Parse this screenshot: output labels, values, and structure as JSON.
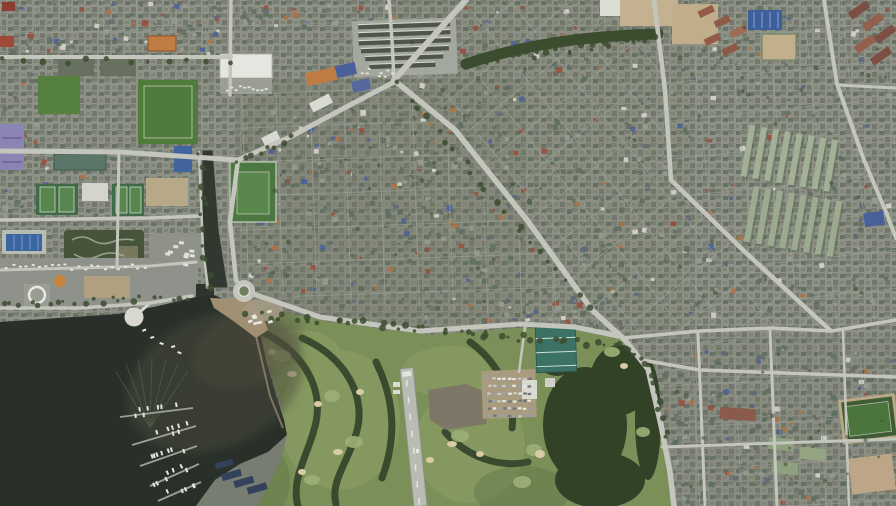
{
  "scene": {
    "type": "satellite-aerial-photograph",
    "description": "Daytime satellite view of a dense coastal city: dark harbor lake with marina piers and moored boats (lower left), a traffic roundabout at the lake head, a canal, sports-and-leisure grounds (upper left), rows of market sheds and a large road junction (top center), tightly packed low-rise housing grids, apartment-row complexes (right), and a large golf course with a small airstrip and parking lot (bottom center)",
    "features": [
      {
        "name": "harbor-lake",
        "label": "dark harbor lake"
      },
      {
        "name": "sediment-plume",
        "label": "brown shallow-water plume"
      },
      {
        "name": "marina-piers",
        "label": "piers with moored boats"
      },
      {
        "name": "wake-streaks",
        "label": "boat wakes / bird streaks on water"
      },
      {
        "name": "viewing-deck",
        "label": "round white waterfront deck"
      },
      {
        "name": "beach-spit",
        "label": "tan beach slope"
      },
      {
        "name": "roundabout",
        "label": "traffic roundabout"
      },
      {
        "name": "canal",
        "label": "canal joining the lake"
      },
      {
        "name": "golf-course",
        "label": "golf course with tree lines, greens and bunkers"
      },
      {
        "name": "airstrip-runway",
        "label": "small paved runway"
      },
      {
        "name": "golf-parking-lot",
        "label": "parking lot full of cars"
      },
      {
        "name": "driving-range-building",
        "label": "teal-roofed club building"
      },
      {
        "name": "forest-grove",
        "label": "dense dark grove"
      },
      {
        "name": "market-sheds",
        "label": "rows of long market sheds"
      },
      {
        "name": "big-box-store",
        "label": "white flat-roofed store"
      },
      {
        "name": "school-yards",
        "label": "tan school yards"
      },
      {
        "name": "swimming-pool",
        "label": "blue outdoor pool"
      },
      {
        "name": "tennis-courts",
        "label": "green court cluster"
      },
      {
        "name": "athletics-field",
        "label": "fenced green playing field"
      },
      {
        "name": "go-kart-garden",
        "label": "winding garden paths"
      },
      {
        "name": "heliport-pad",
        "label": "white circular pad"
      },
      {
        "name": "apartment-rows",
        "label": "parallel apartment blocks"
      },
      {
        "name": "rowhouses",
        "label": "red-brown row houses"
      },
      {
        "name": "solar-buildings",
        "label": "dark panel-roofed sheds"
      },
      {
        "name": "tree-avenue",
        "label": "tree-lined avenue"
      },
      {
        "name": "residential-grid",
        "label": "dense housing grid districts"
      }
    ]
  },
  "palette": {
    "urbanBase": "#8e9186",
    "urbanDark": "#656b5e",
    "roofGray": "#999d92",
    "roofGreen": "#5b6e5e",
    "roofTeal": "#4e7c6e",
    "roofSlate": "#5c6878",
    "roofOrange": "#b2713f",
    "roofBlue": "#4a5f9b",
    "roofRed": "#9c4a38",
    "roofWhite": "#d9d9d1",
    "roadMajor": "#c4c6bd",
    "roadMinor": "#9aa096",
    "water": "#29302a",
    "sediment": "#4a493b",
    "beach": "#a08f72",
    "golf": "#7b8f58",
    "golfLight": "#8a9d64",
    "golfDark": "#62764a",
    "trees": "#3c4c2f",
    "treesDark": "#2f3e25",
    "runway": "#b9bcb3",
    "sand": "#c0ad8a",
    "tan": "#b7a887",
    "purple": "#8a85b5",
    "poolBlue": "#3b66a0",
    "panelBlue": "#33415a",
    "teal": "#3c7265",
    "fieldGreen": "#55803f",
    "white": "#e4e4de"
  }
}
